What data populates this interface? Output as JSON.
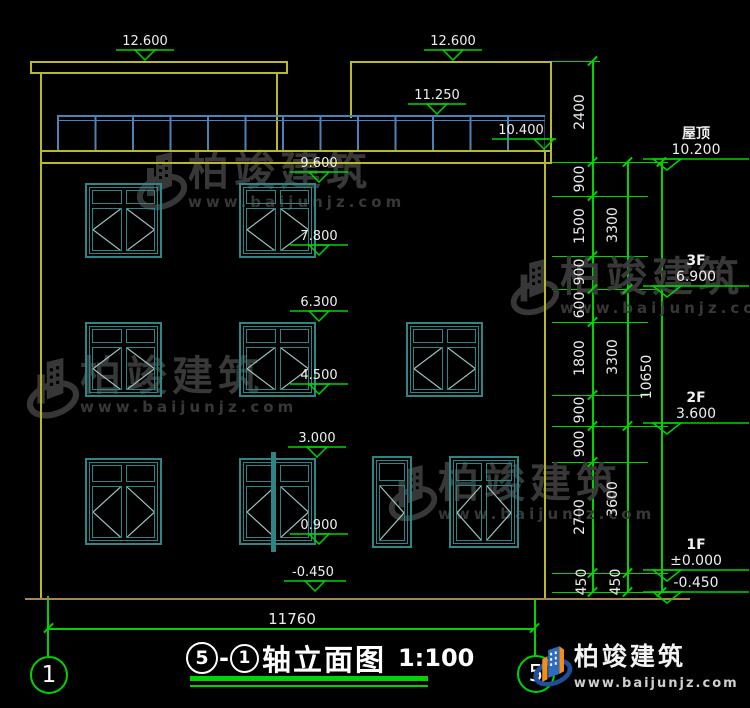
{
  "title": {
    "axis_a": "5",
    "axis_b": "1",
    "name": "轴立面图",
    "scale": "1:100"
  },
  "markers": {
    "canopy_left": "12.600",
    "bulkhead": "12.600",
    "railing": "11.250",
    "parapet": "10.400",
    "f3_win_top": "9.600",
    "f3_win_bottom": "7.800",
    "f2_win_top": "6.300",
    "f2_win_bottom": "4.500",
    "f1_win_top": "3.000",
    "f1_win_bottom": "0.900",
    "ground_left": "-0.450"
  },
  "levels": {
    "roof": {
      "label": "屋顶",
      "value": "10.200"
    },
    "f3": {
      "label": "3F",
      "value": "6.900"
    },
    "f2": {
      "label": "2F",
      "value": "3.600"
    },
    "f1": {
      "label": "1F",
      "value": "±0.000"
    },
    "basement": {
      "value": "-0.450"
    }
  },
  "dims": {
    "inner": [
      "2400",
      "900",
      "1500",
      "900",
      "600",
      "1800",
      "900",
      "900",
      "2700",
      "450"
    ],
    "outer": [
      "3300",
      "3300",
      "3600",
      "450"
    ],
    "total_height": "10650",
    "total_width": "11760"
  },
  "axes": {
    "left": "1",
    "right": "5"
  },
  "watermark": {
    "name": "柏竣建筑",
    "url": "www.baijunjz.com"
  }
}
